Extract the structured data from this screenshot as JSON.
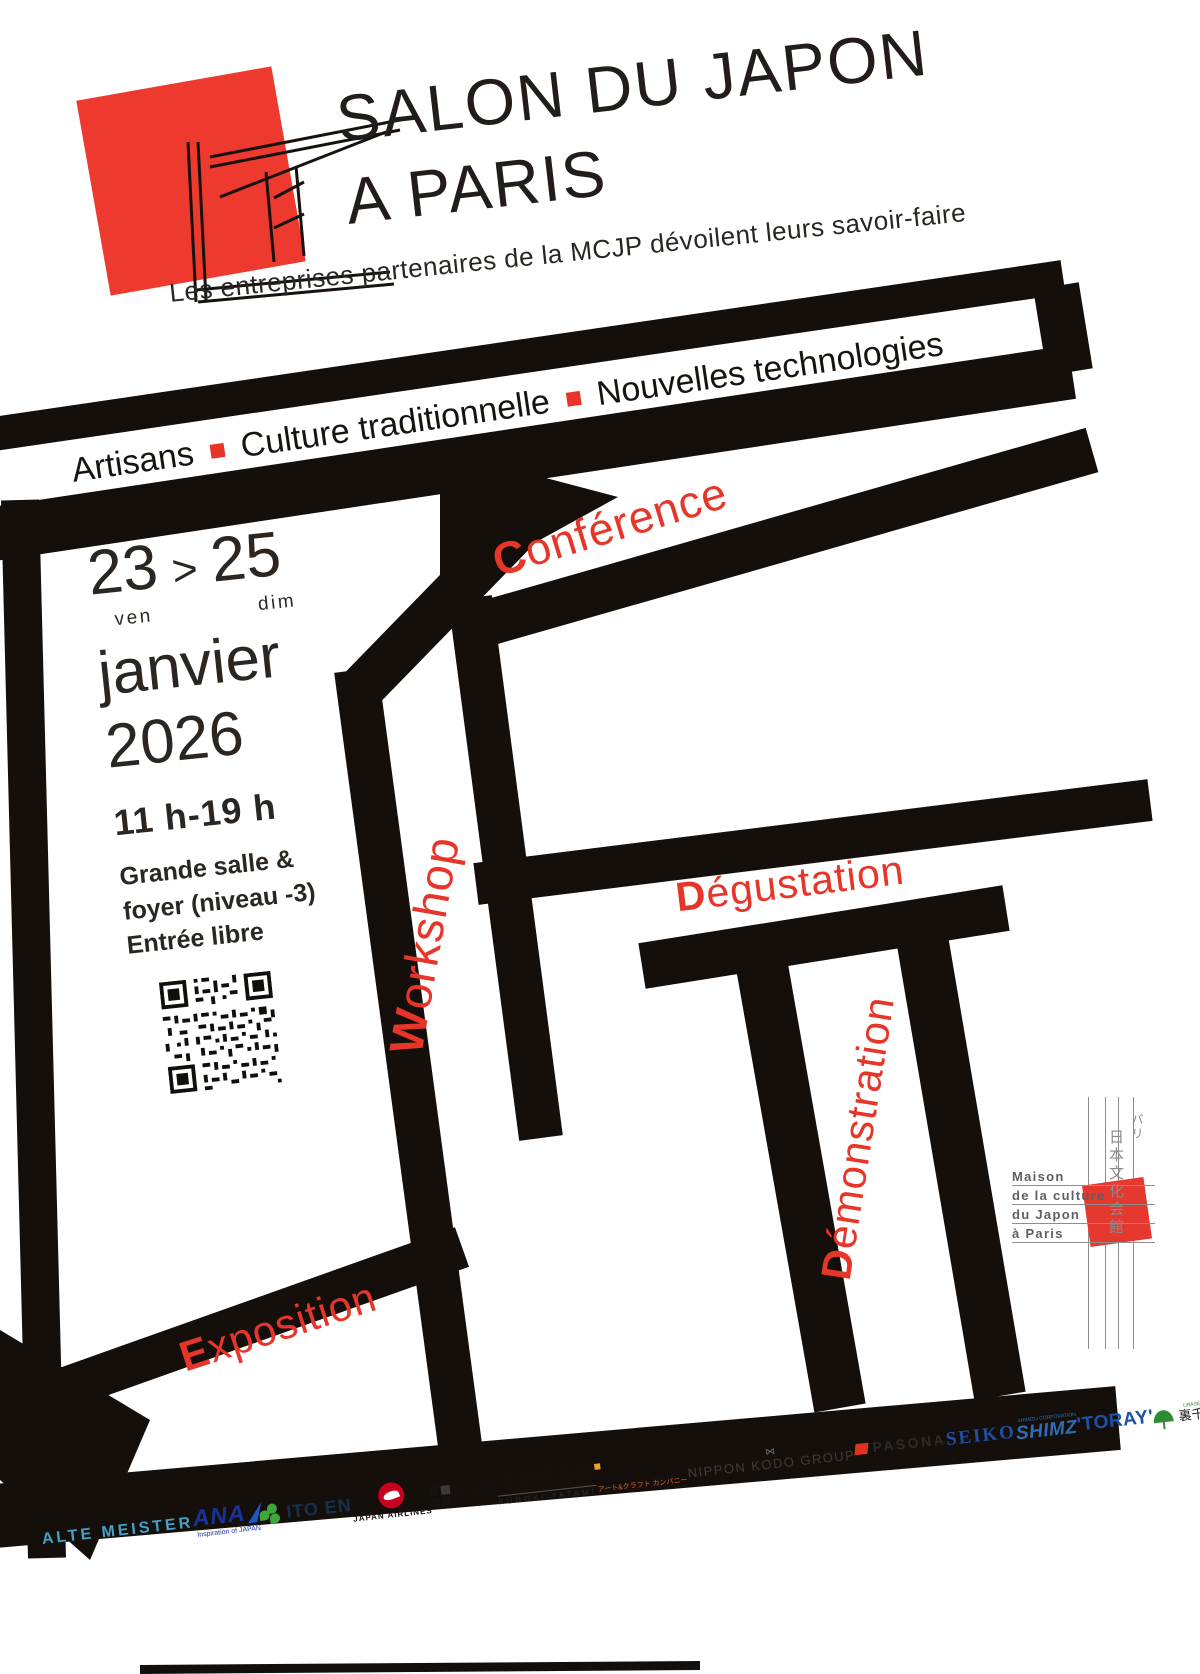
{
  "title": {
    "line1": "SALON DU JAPON",
    "line2": "A PARIS"
  },
  "subtitle": {
    "text": "Les entreprises partenaires de la MCJP dévoilent leurs savoir-faire"
  },
  "banner": {
    "items": [
      "Artisans",
      "Culture traditionnelle",
      "Nouvelles technologies"
    ]
  },
  "dates": {
    "start_day": "23",
    "separator": ">",
    "end_day": "25",
    "start_dow": "ven",
    "end_dow": "dim",
    "month": "janvier",
    "year": "2026",
    "hours": "11 h-19 h",
    "venue1": "Grande salle &",
    "venue2": "foyer (niveau -3)",
    "venue3": "Entrée libre"
  },
  "activities": {
    "conference": {
      "initial": "C",
      "rest": "onférence"
    },
    "workshop": {
      "initial": "W",
      "rest": "orkshop"
    },
    "degustation": {
      "initial": "D",
      "rest": "égustation"
    },
    "demonstration": {
      "initial": "D",
      "rest": "émonstration"
    },
    "exposition": {
      "initial": "E",
      "rest": "xposition"
    }
  },
  "mcjp": {
    "name_lines": [
      "Maison",
      "de la culture",
      "du Japon",
      "à Paris"
    ],
    "jp_city": "パリ",
    "jp_name": "日本文化会館"
  },
  "sponsors": [
    {
      "name": "ALTE MEISTER"
    },
    {
      "name": "ANA",
      "tagline": "Inspiration of JAPAN"
    },
    {
      "name": "ITO EN"
    },
    {
      "name": "JAPAN AIRLINES"
    },
    {
      "name": "A-UN"
    },
    {
      "name": "久保木畳店",
      "sub": "KUBOKI TATAMI"
    },
    {
      "name": "Kuretake",
      "sub": "アート&クラフト カンパニー"
    },
    {
      "name": "NIPPON KODO GROUP"
    },
    {
      "name": "PASONA"
    },
    {
      "name": "SEIKO"
    },
    {
      "name": "SHIMZ",
      "sub": "SHIMIZU CORPORATION"
    },
    {
      "name": "'TORAY'"
    },
    {
      "name": "裏千家",
      "sub": "URASENKE"
    }
  ],
  "colors": {
    "accent_red": "#e63529",
    "logo_red": "#ee392e",
    "structure_black": "#140f0b",
    "mcjp_red": "#e5392f"
  }
}
